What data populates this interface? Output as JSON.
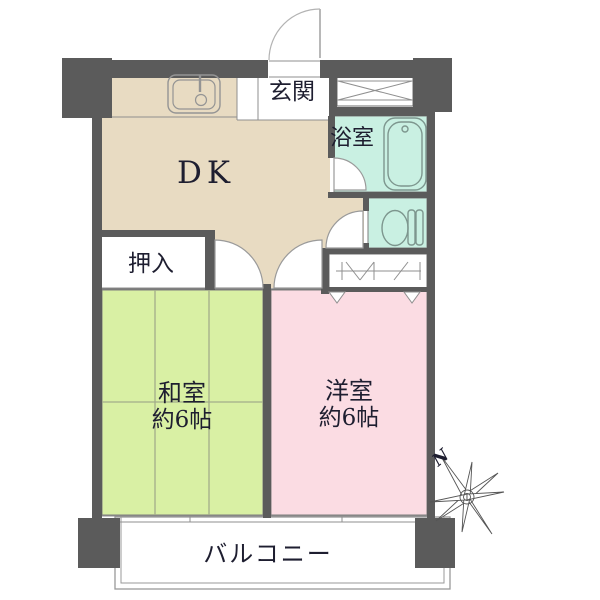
{
  "floorplan": {
    "rooms": {
      "dk": {
        "label": "DK"
      },
      "genkan": {
        "label": "玄関"
      },
      "bathroom": {
        "label": "浴室"
      },
      "oshiire": {
        "label": "押入"
      },
      "washitsu": {
        "label": "和室",
        "size": "約6帖"
      },
      "youshitsu": {
        "label": "洋室",
        "size": "約6帖"
      },
      "balcony": {
        "label": "バルコニー"
      }
    },
    "compass": {
      "north": "N"
    },
    "colors": {
      "wall": "#5b5b5b",
      "dk_floor": "#e8dbc2",
      "washitsu_floor": "#d9f0a4",
      "youshitsu_floor": "#fbdce3",
      "wet_area_floor": "#c9f0e2"
    }
  }
}
